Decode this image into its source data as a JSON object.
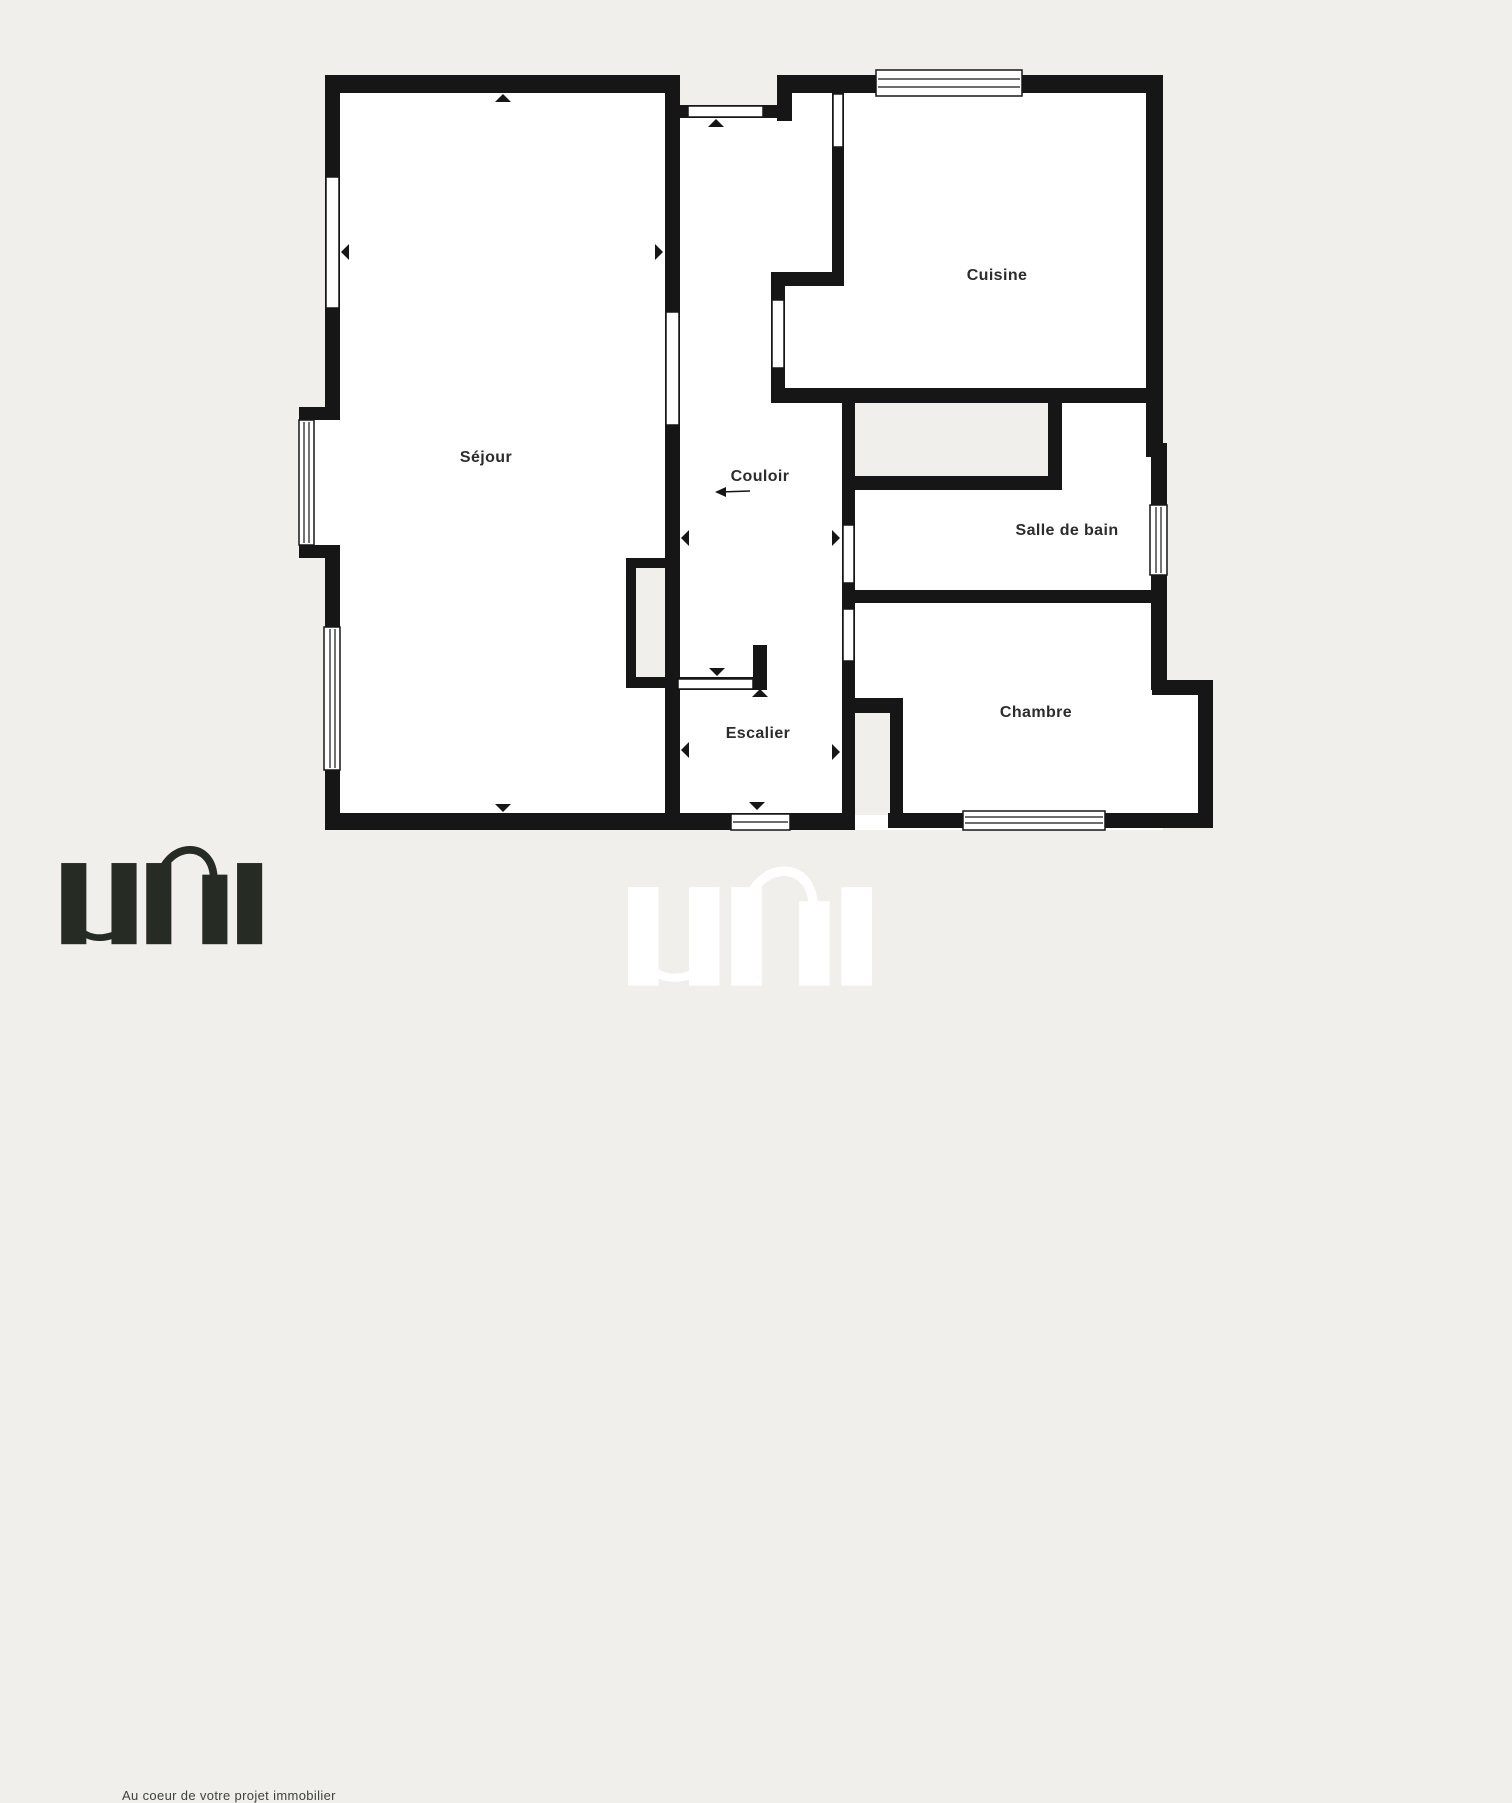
{
  "colors": {
    "background": "#f1efeb",
    "wall": "#161616",
    "room": "#ffffff",
    "label": "#2c2c2c",
    "logo": "#262b24",
    "watermark": "#ffffff"
  },
  "rooms": {
    "sejour": {
      "label": "Séjour"
    },
    "couloir": {
      "label": "Couloir"
    },
    "cuisine": {
      "label": "Cuisine"
    },
    "salle_de_bain": {
      "label": "Salle de bain"
    },
    "chambre": {
      "label": "Chambre"
    },
    "escalier": {
      "label": "Escalier"
    }
  },
  "branding": {
    "logo_text": "uni",
    "tagline": "Au coeur de votre projet immobilier",
    "watermark_text": "uni"
  },
  "icons": {
    "window_symbol": "double-line window glyph",
    "door_opening": "white gap in wall",
    "direction_arrow": "small solid triangle"
  }
}
